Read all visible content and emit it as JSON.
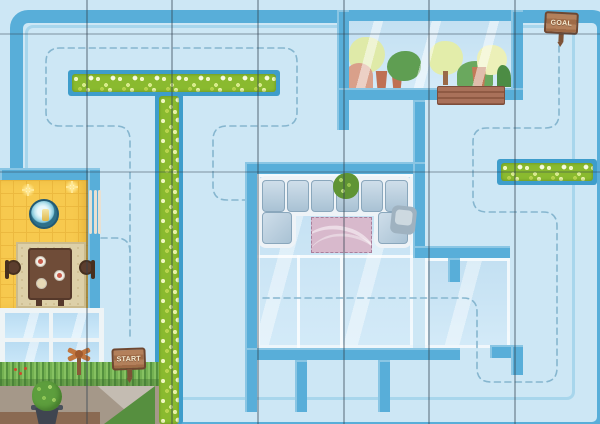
{
  "scene": {
    "name": "Top-down house maze play mat",
    "description": "Maze game board through rooms of a house from START to GOAL"
  },
  "signs": {
    "start": {
      "label": "START"
    },
    "goal": {
      "label": "GOAL"
    }
  },
  "palette": {
    "background": "#cde7f5",
    "wall": "#58aed9",
    "wall_highlight": "#a8d6ec",
    "hedge_green": "#8aba2f",
    "hedge_base_blue": "#3e9dcb",
    "dashed_path": "#86b6cf",
    "glass": "#cfe8f6",
    "yellow_floor": "#f7c94e",
    "rug_pink": "#d8b9cc",
    "rug_beige": "#ddd0a8",
    "sign_wood": "#a9744f",
    "grass": "#74b152",
    "dirt": "#a59889",
    "planter_wood": "#a9715a"
  },
  "rooms": [
    {
      "id": "greenhouse",
      "label": "greenhouse with plants"
    },
    {
      "id": "living-room",
      "label": "glass living room with sofa"
    },
    {
      "id": "dining-room",
      "label": "yellow dining room"
    },
    {
      "id": "garden",
      "label": "garden with grass and potted bush"
    }
  ],
  "objects": [
    "goal-sign",
    "start-sign",
    "flower-hedge-t",
    "flower-hedge-right",
    "sofa",
    "pink-rug",
    "houseplant",
    "armchair",
    "dining-table",
    "chairs",
    "round-table",
    "wall-sparkles",
    "window",
    "planter-box",
    "potted-bush",
    "whirligig",
    "dashed-route"
  ]
}
